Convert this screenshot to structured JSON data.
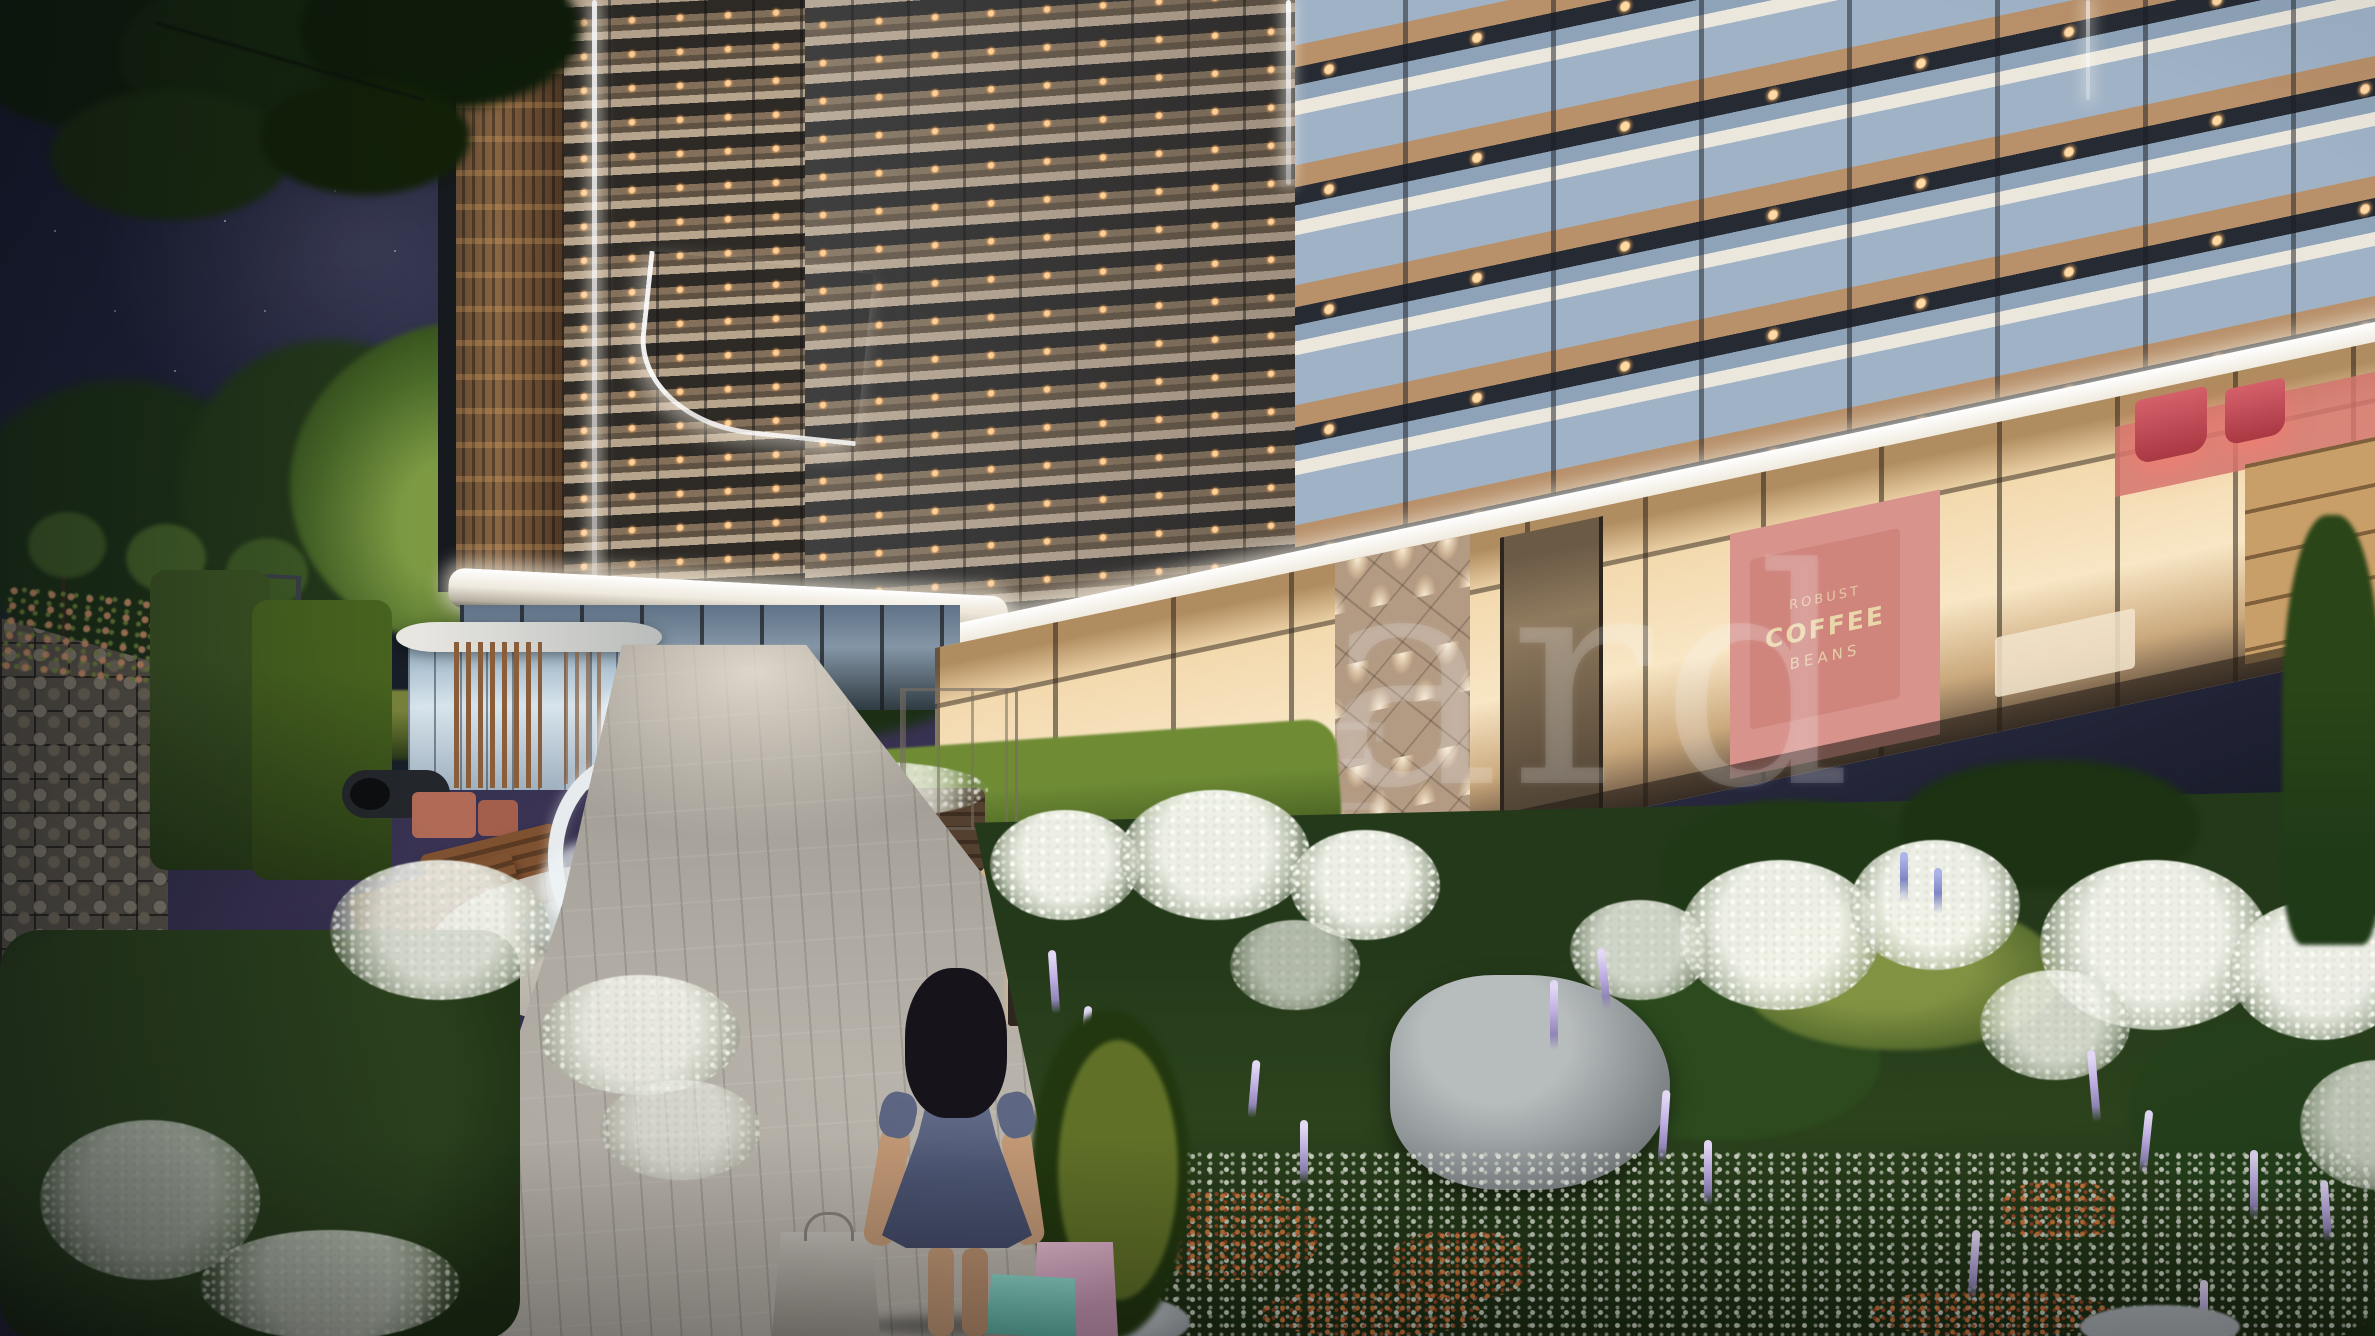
{
  "scene": {
    "description": "Night architectural rendering of a residential complex courtyard: starry sky, high-rise with lit balconies, glowing canopy over storefronts, ring fountain, garden path, girl with shopping bags, flower gardens",
    "watermark": {
      "large_fragment": "ard",
      "small_fragment": "E"
    },
    "coffee_shop": {
      "wall_art_words": [
        "ROBUST",
        "COFFEE",
        "BEANS"
      ]
    },
    "palette": {
      "sky_top": "#1b1f33",
      "sky_glow": "#3a3354",
      "facade_beige": "#b3a08a",
      "window_warm": "#ffc98e",
      "glass_blue": "#8fa6bc",
      "wood": "#8a5e3b",
      "canopy_white": "#f6f2e9",
      "storefront_warm": "#f5ddb5",
      "coffee_wall_pink": "#d8938c",
      "pendant_red": "#c4414e",
      "garden_green": "#2c431d",
      "hydrangea_white": "#e9eae4",
      "lavender": "#b5a6d8",
      "sedum_orange": "#cc7a40",
      "path_grey": "#b3afa8",
      "dress_blue": "#566080",
      "bag_grey": "#b7b1a8",
      "bag_teal": "#7fd0c2",
      "bag_pink": "#d9a9c0"
    }
  }
}
